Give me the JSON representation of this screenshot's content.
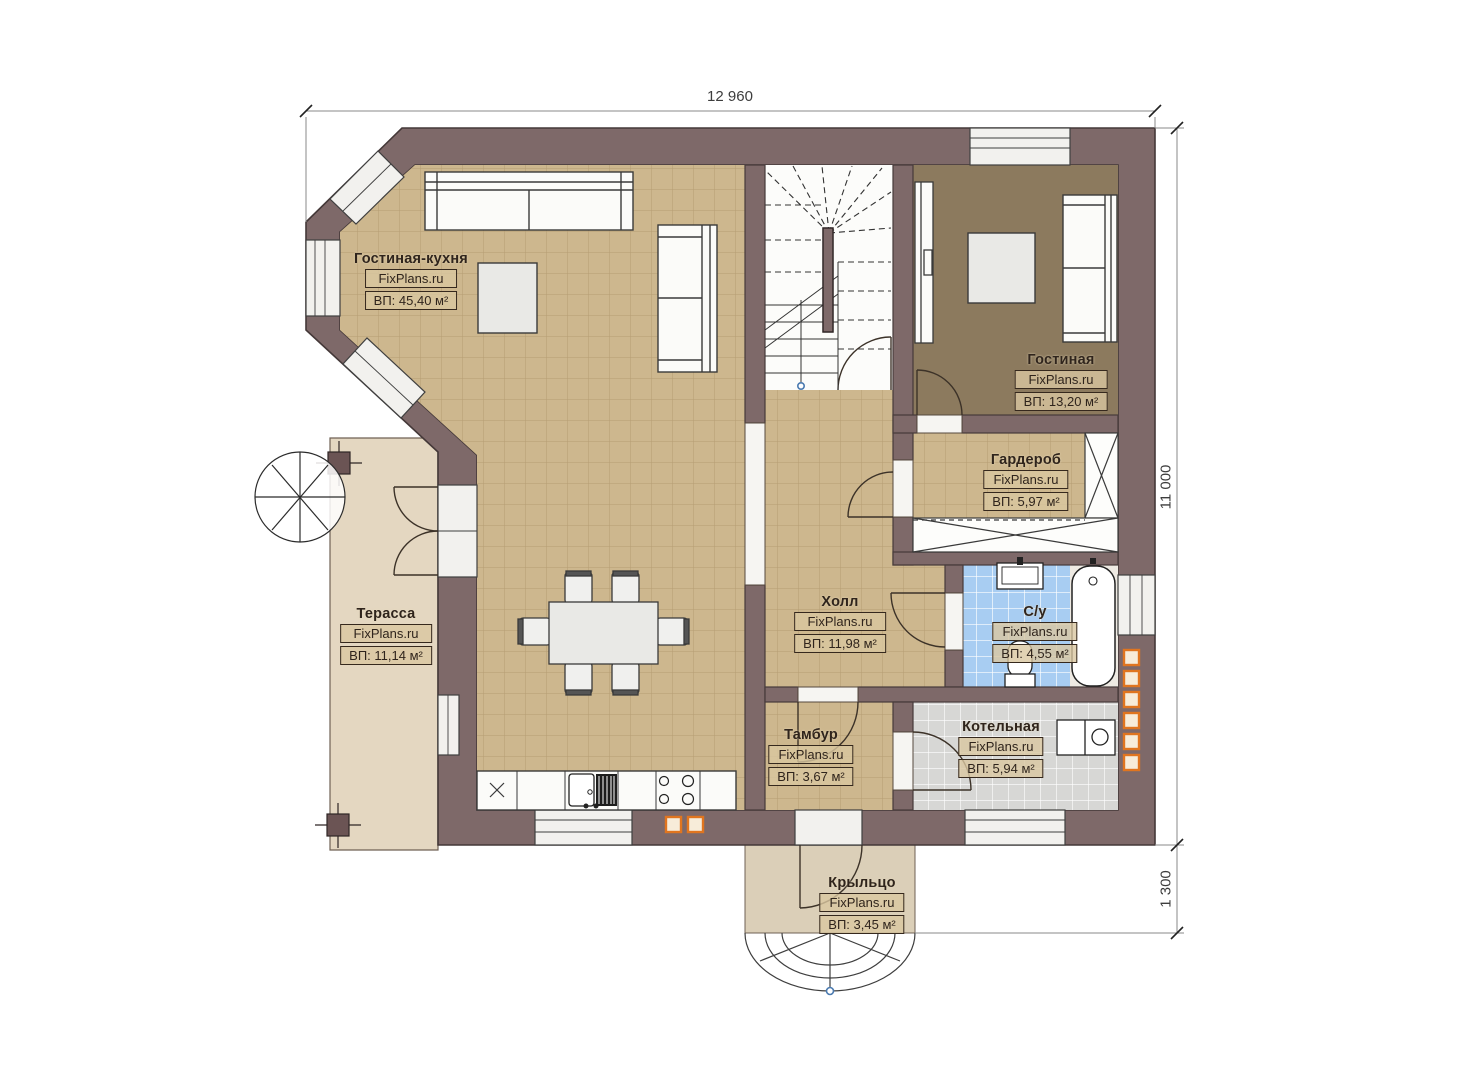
{
  "dimensions": {
    "top": "12 960",
    "right": "11 000",
    "right_lower": "1 300"
  },
  "brand": "FixPlans.ru",
  "rooms": [
    {
      "id": "living-kitchen",
      "name": "Гостиная-кухня",
      "brand": "FixPlans.ru",
      "area": "ВП: 45,40 м²"
    },
    {
      "id": "living-room",
      "name": "Гостиная",
      "brand": "FixPlans.ru",
      "area": "ВП: 13,20 м²"
    },
    {
      "id": "wardrobe",
      "name": "Гардероб",
      "brand": "FixPlans.ru",
      "area": "ВП: 5,97 м²"
    },
    {
      "id": "hall",
      "name": "Холл",
      "brand": "FixPlans.ru",
      "area": "ВП: 11,98 м²"
    },
    {
      "id": "bathroom",
      "name": "С/у",
      "brand": "FixPlans.ru",
      "area": "ВП: 4,55 м²"
    },
    {
      "id": "terrace",
      "name": "Терасса",
      "brand": "FixPlans.ru",
      "area": "ВП: 11,14 м²"
    },
    {
      "id": "vestibule",
      "name": "Тамбур",
      "brand": "FixPlans.ru",
      "area": "ВП: 3,67 м²"
    },
    {
      "id": "boiler-room",
      "name": "Котельная",
      "brand": "FixPlans.ru",
      "area": "ВП: 5,94 м²"
    },
    {
      "id": "porch",
      "name": "Крыльцо",
      "brand": "FixPlans.ru",
      "area": "ВП: 3,45 м²"
    }
  ],
  "colors": {
    "wall": "#7e6969",
    "floor_tan": "#cdb78e",
    "floor_dark": "#8c7a5e",
    "floor_blue": "#a8cdf2",
    "floor_gray": "#d7d7d5",
    "terrace": "#e4d7c1",
    "porch": "#dbcfb8",
    "accent_orange": "#e0751f"
  }
}
